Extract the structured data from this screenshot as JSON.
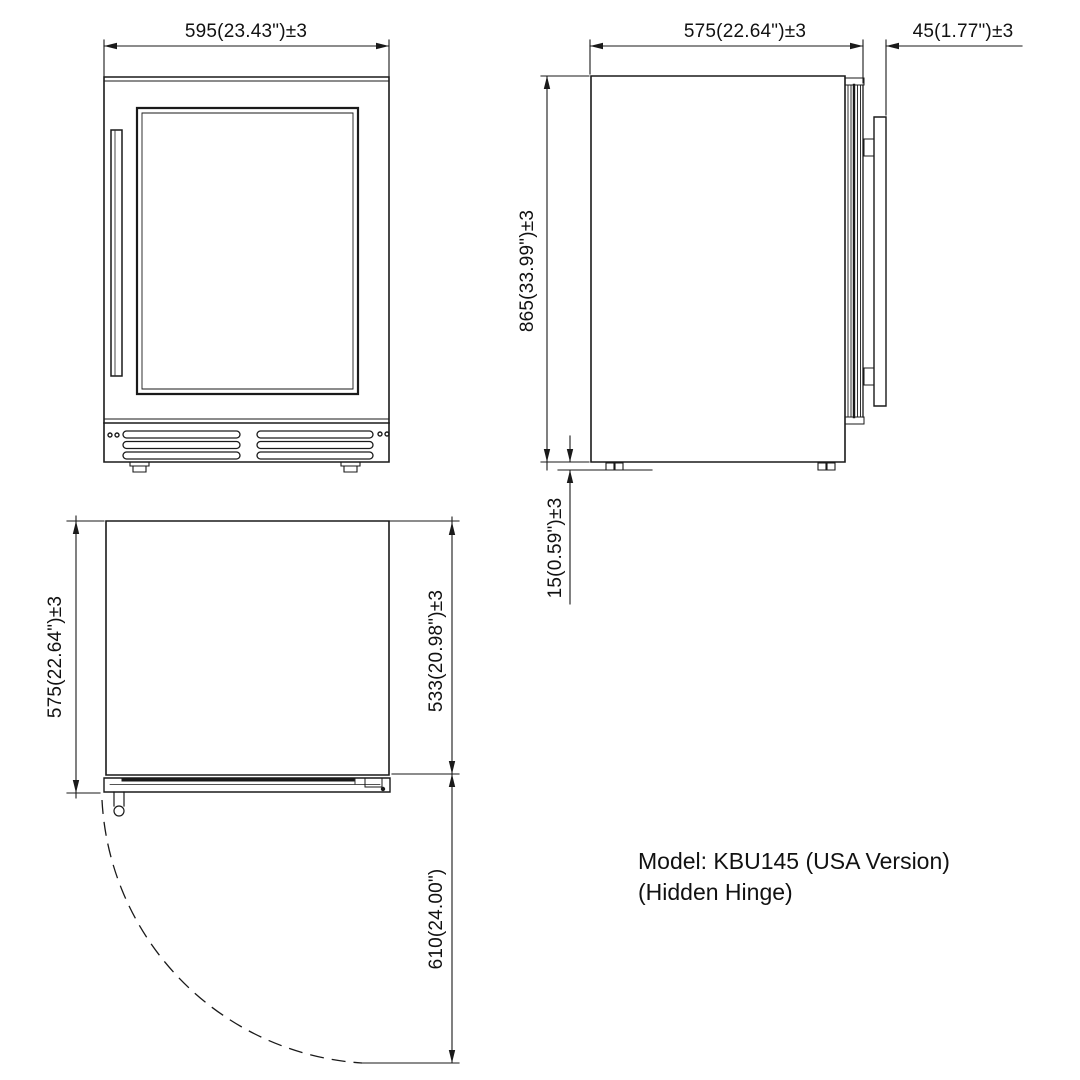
{
  "dimensions": {
    "front_width": "595(23.43\")±3",
    "side_depth": "575(22.64\")±3",
    "side_handle_depth": "45(1.77\")±3",
    "side_height": "865(33.99\")±3",
    "side_foot_height": "15(0.59\")±3",
    "top_depth": "575(22.64\")±3",
    "top_body_depth": "533(20.98\")±3",
    "top_door_swing": "610(24.00\")"
  },
  "model": {
    "line1": "Model: KBU145 (USA Version)",
    "line2": "(Hidden Hinge)"
  },
  "colors": {
    "line": "#1a1a1a",
    "background": "#ffffff"
  }
}
